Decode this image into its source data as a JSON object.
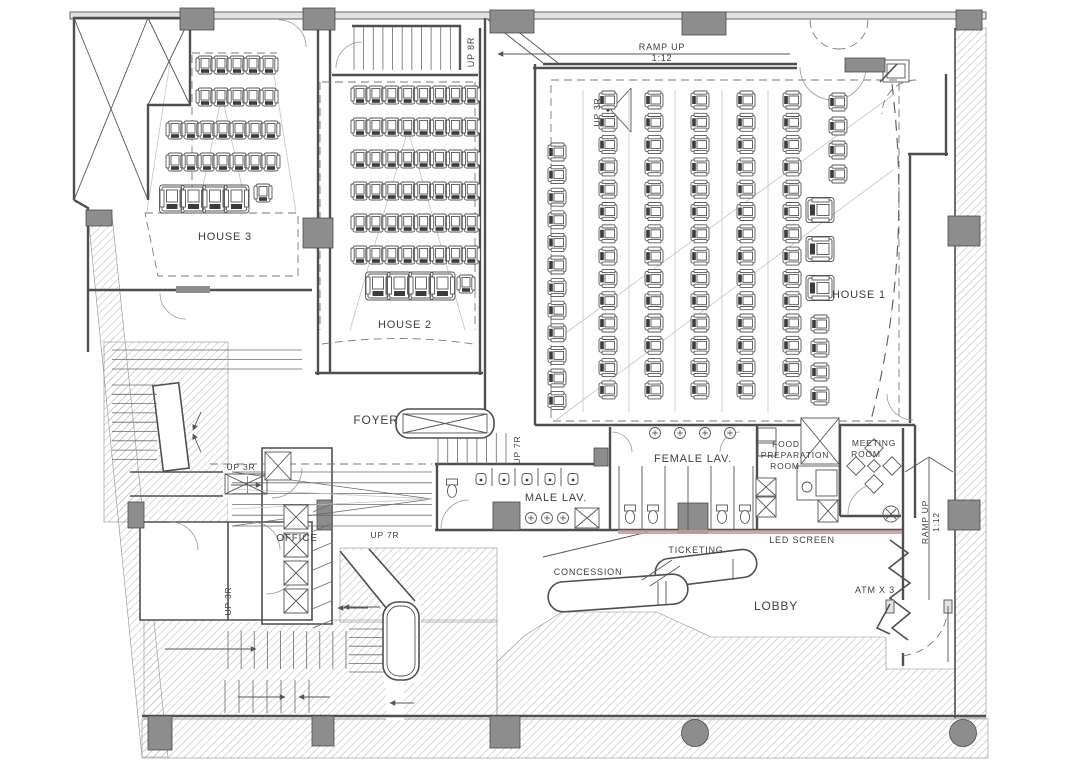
{
  "meta": {
    "drawing_type": "cinema-ground-floor-plan"
  },
  "rooms": {
    "house1": {
      "label": "HOUSE 1"
    },
    "house2": {
      "label": "HOUSE 2"
    },
    "house3": {
      "label": "HOUSE 3"
    },
    "foyer": {
      "label": "FOYER"
    },
    "female_lav": {
      "label": "FEMALE LAV."
    },
    "male_lav": {
      "label": "MALE LAV."
    },
    "food_prep": {
      "line1": "FOOD",
      "line2": "PREPARATION",
      "line3": "ROOM"
    },
    "meeting": {
      "line1": "MEETING",
      "line2": "ROOM"
    },
    "office": {
      "label": "OFFICE"
    },
    "lobby": {
      "label": "LOBBY"
    }
  },
  "features": {
    "concession": "CONCESSION",
    "ticketing": "TICKETING",
    "led_screen": "LED SCREEN",
    "atm": "ATM X 3"
  },
  "circulation": {
    "ramp_top": {
      "line1": "RAMP UP",
      "line2": "1:12"
    },
    "ramp_right": {
      "line1": "RAMP UP",
      "line2": "1:12"
    },
    "up_8r": "UP 8R",
    "up_3r_house1": "UP 3R",
    "up_3r_office": "UP 3R",
    "up_3r_lower": "UP 3R",
    "up_7r_stair": "UP 7R",
    "up_7r_ramp": "UP 7R"
  },
  "colors": {
    "line": "#4f4f4f",
    "hatch": "#b9b9b9",
    "column": "#8d8d8d",
    "text": "#3f3f3f",
    "led_accent": "#c59a96",
    "paper": "#ffffff"
  }
}
